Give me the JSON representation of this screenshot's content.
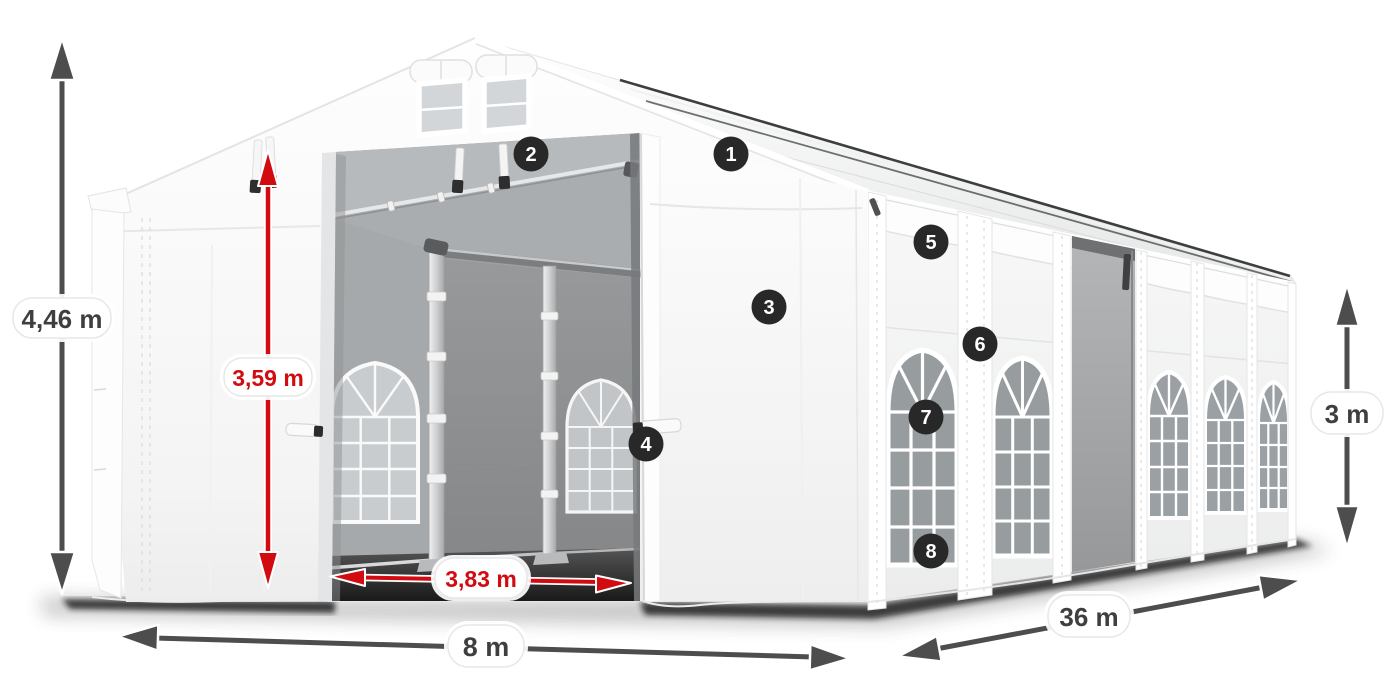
{
  "diagram": {
    "subject": "Large white marquee tent shown in perspective with dimension annotations and numbered feature callouts",
    "dimensions": {
      "total_height": "4,46 m",
      "inner_height": "3,59 m",
      "entrance_width": "3,83 m",
      "width": "8 m",
      "length": "36 m",
      "side_height": "3 m"
    },
    "callouts": [
      {
        "number": "1"
      },
      {
        "number": "2"
      },
      {
        "number": "3"
      },
      {
        "number": "4"
      },
      {
        "number": "5"
      },
      {
        "number": "6"
      },
      {
        "number": "7"
      },
      {
        "number": "8"
      }
    ],
    "colors": {
      "dimension_arrow_gray": "#4d4d4d",
      "dimension_text_gray": "#3f3f3f",
      "dimension_red": "#d20b10",
      "callout_background": "#282828",
      "callout_text": "#ffffff",
      "tent_white": "#f7f7f7",
      "interior_gray": "#a6a9ab"
    }
  }
}
